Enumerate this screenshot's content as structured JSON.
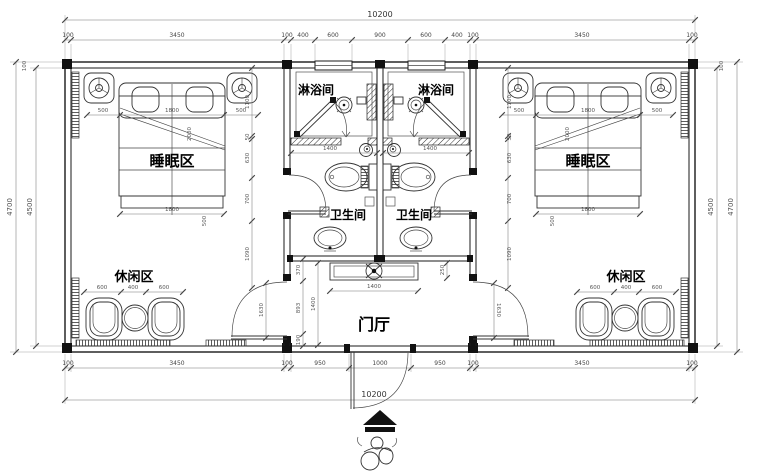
{
  "plan": {
    "rooms": {
      "shower": "淋浴间",
      "sleep": "睡眠区",
      "wc": "卫生间",
      "leisure": "休闲区",
      "hall": "门厅"
    },
    "dims": {
      "total": "10200",
      "top": [
        "100",
        "3450",
        "100",
        "400",
        "600",
        "900",
        "600",
        "400",
        "100",
        "3450",
        "100"
      ],
      "bottom": [
        "100",
        "3450",
        "100",
        "950",
        "1000",
        "950",
        "100",
        "3450",
        "100"
      ],
      "side_outer": "4700",
      "side_inner": "4500",
      "wall": "100",
      "bed_side": "500",
      "bed_width": "1800",
      "bed_diag": "2000",
      "seat_side": "600",
      "seat_mid": "400",
      "wc_width": "1400",
      "chain": [
        "1100",
        "50",
        "630",
        "700",
        "1090"
      ],
      "cabinet_w": "1400",
      "cabinet_d": "250",
      "cabinet_off": "370",
      "hall_d": "1400",
      "hall_a": "893",
      "hall_b": "190",
      "door_h": "1630"
    }
  }
}
